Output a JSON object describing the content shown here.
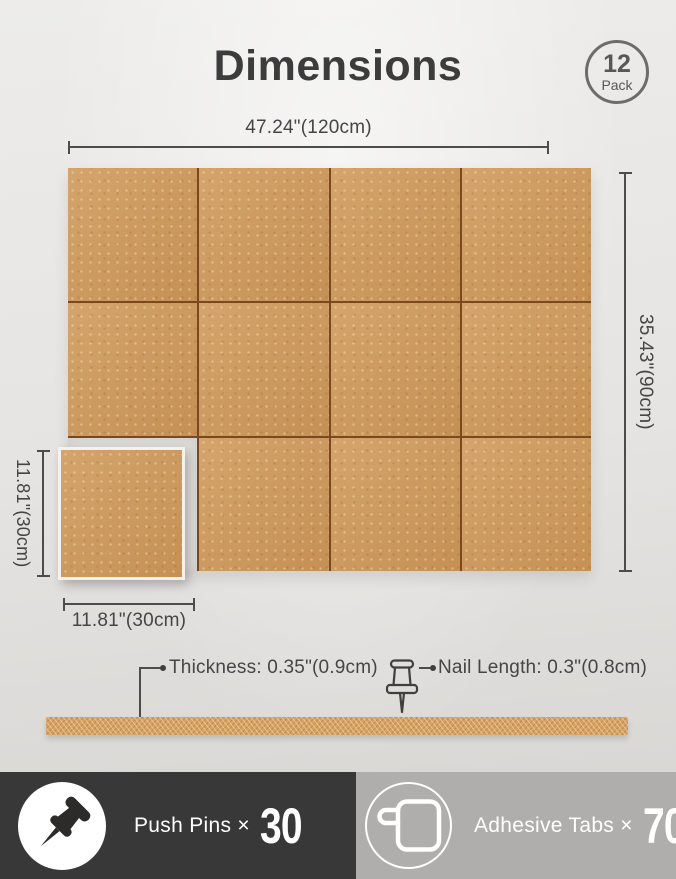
{
  "header": {
    "title": "Dimensions",
    "pack_badge": {
      "count": "12",
      "label": "Pack"
    }
  },
  "board": {
    "grid": {
      "cols": 4,
      "rows": 3,
      "missing_cell": {
        "row": 3,
        "col": 1
      },
      "tile_count": 12
    },
    "width_label": "47.24\"(120cm)",
    "height_label": "35.43\"(90cm)"
  },
  "single_tile": {
    "height_label": "11.81\"(30cm)",
    "width_label": "11.81\"(30cm)"
  },
  "side_view": {
    "thickness_label": "Thickness: 0.35\"(0.9cm)",
    "nail_length_label": "Nail Length: 0.3\"(0.8cm)"
  },
  "included": {
    "push_pins": {
      "icon": "push-pin-icon",
      "label": "Push Pins ×",
      "count": "30"
    },
    "adhesive_tabs": {
      "icon": "adhesive-tab-icon",
      "label": "Adhesive Tabs ×",
      "count": "70"
    }
  },
  "colors": {
    "cork": "#cf9a5c",
    "seam": "#7a4a1e",
    "dimension_line": "#4c4c4c",
    "text": "#454545",
    "title_text": "#3c3c3c",
    "badge_gray": "#6c6c6c",
    "bar_dark": "#383838",
    "bar_gray": "#b0aeac",
    "bar_text": "#ffffff"
  }
}
